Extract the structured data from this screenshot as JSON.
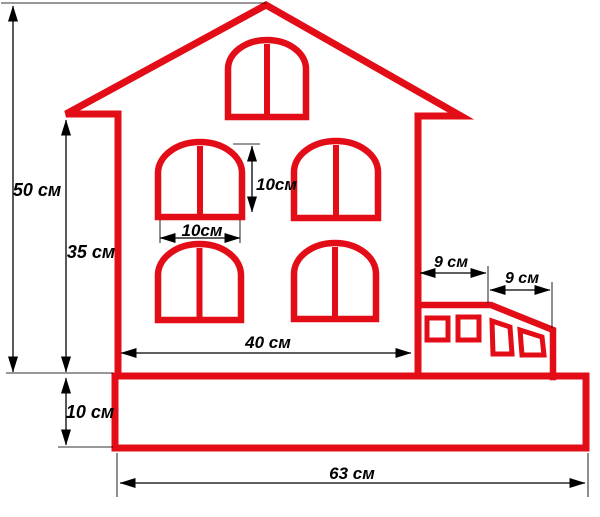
{
  "document": {
    "type": "dimensioned-house-drawing",
    "units": "см"
  },
  "colors": {
    "outline": "#e30d17",
    "dimension": "#000000",
    "background": "#ffffff"
  },
  "dimensions": {
    "total_height": {
      "label": "50 см",
      "value": 50,
      "unit": "см"
    },
    "wall_height": {
      "label": "35 см",
      "value": 35,
      "unit": "см"
    },
    "base_height": {
      "label": "10 см",
      "value": 10,
      "unit": "см"
    },
    "window_height": {
      "label": "10см",
      "value": 10,
      "unit": "см"
    },
    "window_width": {
      "label": "10см",
      "value": 10,
      "unit": "см"
    },
    "house_width": {
      "label": "40 см",
      "value": 40,
      "unit": "см"
    },
    "porch_flat_width": {
      "label": "9 см",
      "value": 9,
      "unit": "см"
    },
    "porch_slope_width": {
      "label": "9 см",
      "value": 9,
      "unit": "см"
    },
    "base_width": {
      "label": "63 см",
      "value": 63,
      "unit": "см"
    }
  }
}
